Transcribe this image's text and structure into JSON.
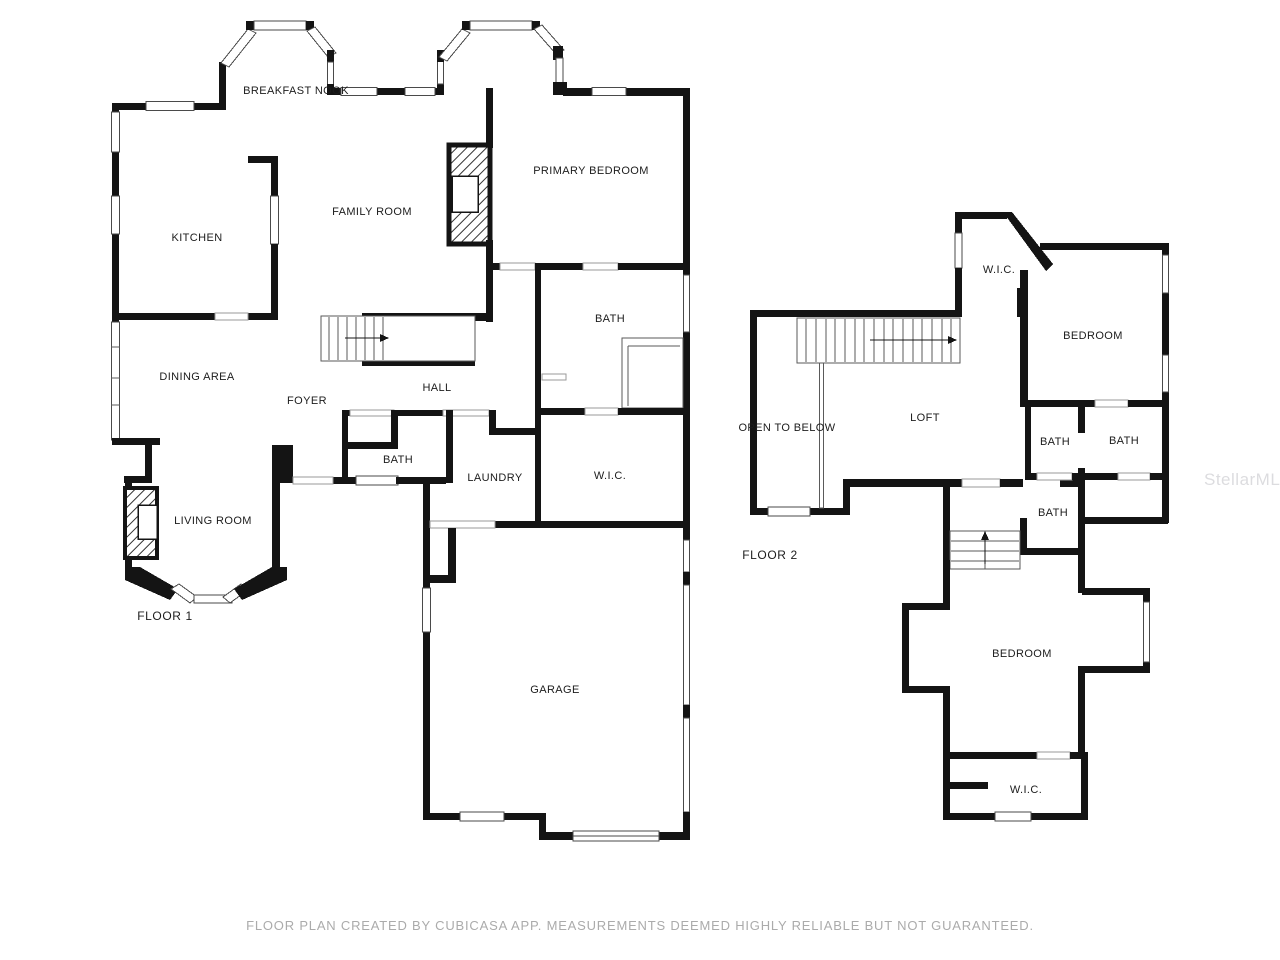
{
  "caption": "FLOOR PLAN CREATED BY CUBICASA APP. MEASUREMENTS DEEMED HIGHLY RELIABLE BUT NOT GUARANTEED.",
  "watermark": "StellarMLS",
  "colors": {
    "wall": "#141414",
    "window_stroke": "#4a4a4a",
    "label": "#1c1c1c",
    "caption": "#ababab"
  },
  "floors": [
    {
      "name": "FLOOR 1",
      "title_pos": {
        "x": 165,
        "y": 616
      },
      "rooms": [
        {
          "id": "breakfast-nook",
          "label": "BREAKFAST NOOK",
          "x": 296,
          "y": 91
        },
        {
          "id": "kitchen",
          "label": "KITCHEN",
          "x": 197,
          "y": 238
        },
        {
          "id": "family-room",
          "label": "FAMILY ROOM",
          "x": 372,
          "y": 212
        },
        {
          "id": "primary-bedroom",
          "label": "PRIMARY BEDROOM",
          "x": 591,
          "y": 171
        },
        {
          "id": "primary-bath",
          "label": "BATH",
          "x": 610,
          "y": 319
        },
        {
          "id": "dining-area",
          "label": "DINING AREA",
          "x": 197,
          "y": 377
        },
        {
          "id": "foyer",
          "label": "FOYER",
          "x": 307,
          "y": 401
        },
        {
          "id": "hall",
          "label": "HALL",
          "x": 437,
          "y": 388
        },
        {
          "id": "half-bath",
          "label": "BATH",
          "x": 398,
          "y": 460
        },
        {
          "id": "laundry",
          "label": "LAUNDRY",
          "x": 495,
          "y": 478
        },
        {
          "id": "wic-primary",
          "label": "W.I.C.",
          "x": 610,
          "y": 476
        },
        {
          "id": "living-room",
          "label": "LIVING ROOM",
          "x": 213,
          "y": 521
        },
        {
          "id": "garage",
          "label": "GARAGE",
          "x": 555,
          "y": 690
        }
      ]
    },
    {
      "name": "FLOOR 2",
      "title_pos": {
        "x": 770,
        "y": 555
      },
      "rooms": [
        {
          "id": "wic-2-top",
          "label": "W.I.C.",
          "x": 999,
          "y": 270
        },
        {
          "id": "bedroom-2",
          "label": "BEDROOM",
          "x": 1093,
          "y": 336
        },
        {
          "id": "loft",
          "label": "LOFT",
          "x": 925,
          "y": 418
        },
        {
          "id": "open-to-below",
          "label": "OPEN TO BELOW",
          "x": 787,
          "y": 428
        },
        {
          "id": "bath-2a",
          "label": "BATH",
          "x": 1055,
          "y": 442
        },
        {
          "id": "bath-2b",
          "label": "BATH",
          "x": 1124,
          "y": 441
        },
        {
          "id": "bath-2c",
          "label": "BATH",
          "x": 1053,
          "y": 513
        },
        {
          "id": "bedroom-3",
          "label": "BEDROOM",
          "x": 1022,
          "y": 654
        },
        {
          "id": "wic-2-bottom",
          "label": "W.I.C.",
          "x": 1026,
          "y": 790
        }
      ]
    }
  ]
}
